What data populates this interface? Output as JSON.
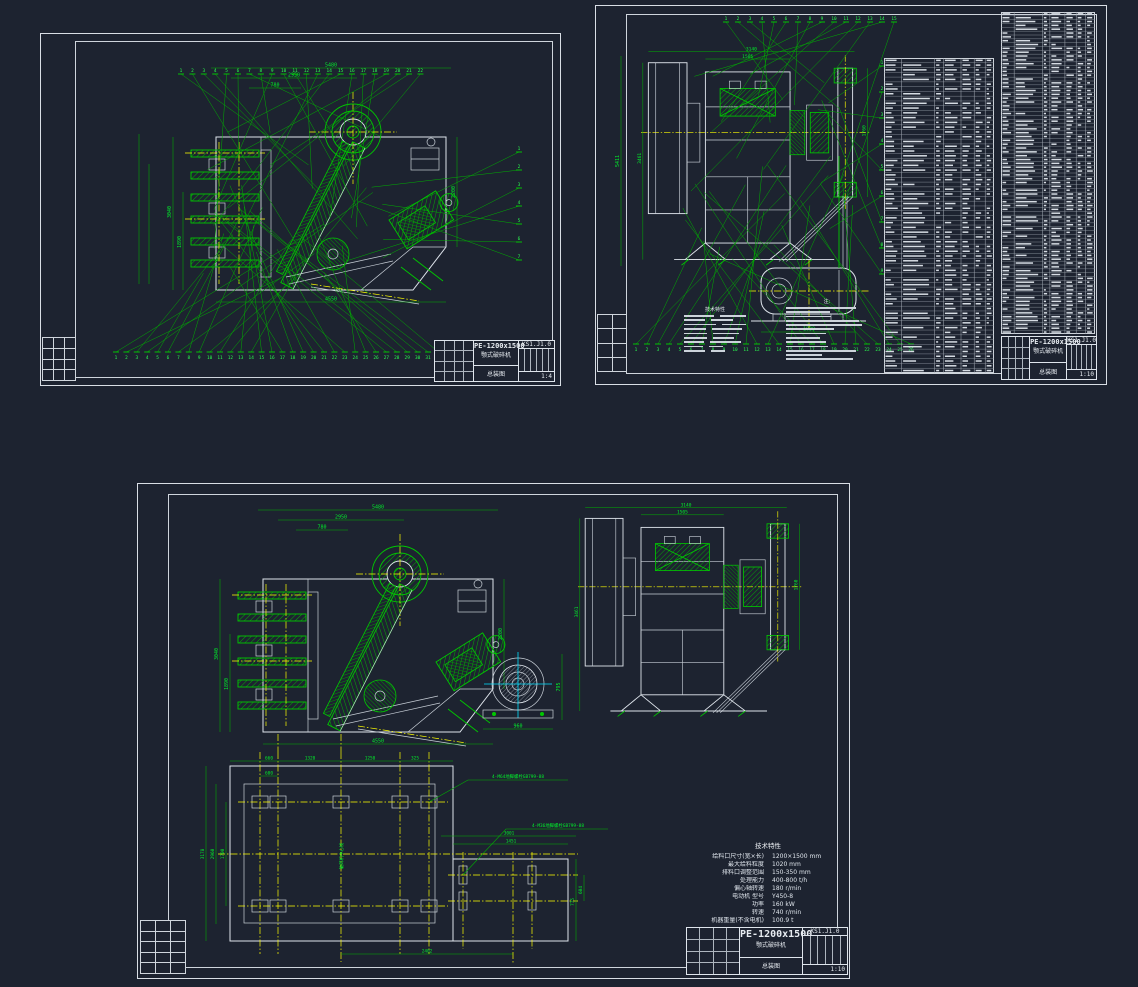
{
  "colors": {
    "background": "#1d2330",
    "green_line": "#00c800",
    "green_text": "#00f02a",
    "yellow": "#ffff00",
    "white": "#dfe5ec",
    "cyan": "#00e0ff"
  },
  "title_block": {
    "model": "PE-1200x1500",
    "product": "颚式破碎机",
    "doc": "总装图",
    "drawing_no": "KS1.J1.0",
    "scale_a": "1:4",
    "scale_b": "1:10",
    "scale_c": "1:10"
  },
  "specs": {
    "header": "技术特性",
    "items": [
      {
        "label": "给料口尺寸(宽×长)",
        "value": "1200×1500 mm"
      },
      {
        "label": "最大给料粒度",
        "value": "1020 mm"
      },
      {
        "label": "排料口调整范围",
        "value": "150-350 mm"
      },
      {
        "label": "处理能力",
        "value": "400-800 t/h"
      },
      {
        "label": "偏心轴转速",
        "value": "180 r/min"
      },
      {
        "label": "电动机 型号",
        "value": "Y450-8"
      },
      {
        "label": "功率",
        "value": "160 kW"
      },
      {
        "label": "转速",
        "value": "740 r/min"
      },
      {
        "label": "机器重量(不含电机)",
        "value": "100.9 t"
      }
    ]
  },
  "notes": {
    "header": "注:",
    "line_count": 13
  },
  "bom": {
    "table1": {
      "rows": 66,
      "cols": [
        0.16,
        0.46,
        0.54,
        0.7,
        0.82,
        0.92
      ]
    },
    "table2": {
      "rows": 84,
      "cols": [
        0.14,
        0.44,
        0.52,
        0.68,
        0.8,
        0.9
      ]
    }
  },
  "balloons": {
    "a_top": 22,
    "a_bottom": 32,
    "a_right": 7,
    "b_top": 15,
    "b_bottom": 26,
    "b_right": 9
  },
  "dims": {
    "sideview": {
      "top": [
        "5480",
        "2950",
        "780"
      ],
      "bottom": [
        "4550"
      ],
      "left": [
        "3040",
        "1890"
      ],
      "right": [
        "2200"
      ]
    },
    "frontview": {
      "top": [
        "3140",
        "1505"
      ],
      "left": [
        "3461"
      ],
      "right": [
        "1760"
      ]
    },
    "motor_b": [
      "1030"
    ],
    "motor_end": [
      "960",
      "795"
    ],
    "foundation": {
      "top": [
        "660",
        "1320",
        "1250",
        "325"
      ],
      "sub": [
        "600"
      ],
      "left": [
        "3178",
        "2960",
        "1700"
      ],
      "bottom": [
        "2402"
      ],
      "motor_top": [
        "3001",
        "1451"
      ],
      "motor_right": [
        "775",
        "604"
      ],
      "callout1": "4-M64地脚螺栓GB799-88",
      "callout2": "4-M36地脚螺栓GB799-88",
      "center_label": "破碎机中心线"
    }
  }
}
